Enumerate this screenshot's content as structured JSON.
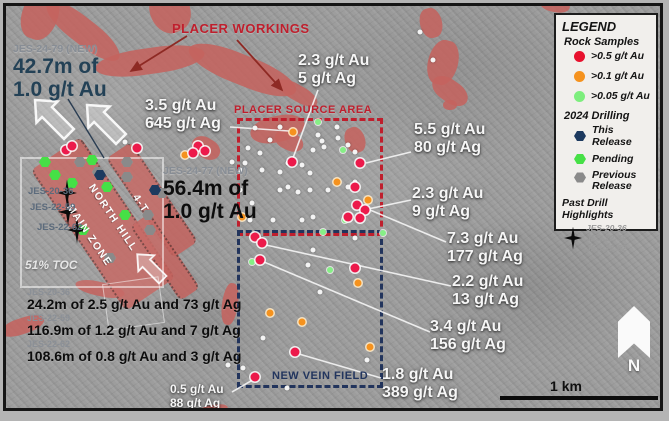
{
  "colors": {
    "salmon": "#c4635e",
    "crimson": "#bf1f2d",
    "steel_text": "#234156",
    "navy_text": "#22355e",
    "sample_red": "#ec1a4b",
    "sample_orange": "#f5921e",
    "sample_green": "#86ef86",
    "hex_navy": "#1d3a5f",
    "hex_green": "#46e046",
    "hex_gray": "#8a8a8a",
    "legend_bg": "#f1efec"
  },
  "annotations": {
    "placer_workings": "PLACER WORKINGS",
    "placer_source_area": "PLACER SOURCE AREA",
    "new_vein_field": "NEW VEIN FIELD",
    "north_hill": "NORTH HILL",
    "main_zone": "MAIN ZONE",
    "vein_4t": "4-T",
    "toc": "51% TOC",
    "scale_label": "1 km",
    "north_label": "N",
    "drill_new": [
      {
        "id": "JES-24-79 (NEW)",
        "line1": "42.7m of",
        "line2": "1.0 g/t Au"
      },
      {
        "id": "JES-24-77 (NEW)",
        "line1": "56.4m of",
        "line2": "1.0 g/t Au"
      }
    ],
    "samples": [
      {
        "line1": "2.3 g/t Au",
        "line2": "5 g/t Ag"
      },
      {
        "line1": "3.5 g/t Au",
        "line2": "645 g/t Ag"
      },
      {
        "line1": "5.5 g/t Au",
        "line2": "80 g/t Ag"
      },
      {
        "line1": "2.3 g/t Au",
        "line2": "9 g/t Ag"
      },
      {
        "line1": "7.3 g/t Au",
        "line2": "177 g/t Ag"
      },
      {
        "line1": "2.2 g/t Au",
        "line2": "13 g/t Ag"
      },
      {
        "line1": "3.4 g/t Au",
        "line2": "156 g/t Ag"
      },
      {
        "line1": "1.8 g/t Au",
        "line2": "389 g/t Ag"
      },
      {
        "line1": "0.5 g/t Au",
        "line2": "88 g/t Ag"
      }
    ],
    "star_holes": [
      "JES-20-36",
      "JES-22-59",
      "JES-22-62"
    ],
    "past_highlights": [
      {
        "id": "JES-20-36",
        "text": "24.2m of 2.5 g/t Au and 73 g/t Ag"
      },
      {
        "id": "JES-22-59",
        "text": "116.9m of 1.2 g/t Au and 7 g/t Ag"
      },
      {
        "id": "JES-22-62",
        "text": "108.6m of 0.8 g/t Au and 3 g/t Ag"
      }
    ]
  },
  "legend": {
    "title": "LEGEND",
    "rock_header": "Rock Samples",
    "rock": [
      {
        "color": "#e8112d",
        "label": ">0.5 g/t Au"
      },
      {
        "color": "#f5921e",
        "label": ">0.1 g/t Au"
      },
      {
        "color": "#7dee7d",
        "label": ">0.05 g/t Au"
      }
    ],
    "drilling_header": "2024 Drilling",
    "drilling": [
      {
        "color": "#1d3a5f",
        "label": "This Release"
      },
      {
        "color": "#46e046",
        "label": "Pending"
      },
      {
        "color": "#8a8a8a",
        "label": "Previous Release"
      }
    ],
    "past_header": "Past Drill Highlights",
    "past_ids": [
      "JES-20-36",
      "JES-22-59",
      "JES-22-62"
    ]
  },
  "markers": {
    "white": [
      [
        226,
        156
      ],
      [
        234,
        164
      ],
      [
        234,
        184
      ],
      [
        237,
        362
      ],
      [
        239,
        157
      ],
      [
        242,
        142
      ],
      [
        244,
        214
      ],
      [
        246,
        197
      ],
      [
        249,
        122
      ],
      [
        254,
        147
      ],
      [
        256,
        164
      ],
      [
        257,
        332
      ],
      [
        264,
        134
      ],
      [
        267,
        214
      ],
      [
        274,
        121
      ],
      [
        274,
        166
      ],
      [
        274,
        184
      ],
      [
        282,
        157
      ],
      [
        282,
        181
      ],
      [
        292,
        186
      ],
      [
        296,
        159
      ],
      [
        296,
        214
      ],
      [
        302,
        259
      ],
      [
        304,
        167
      ],
      [
        304,
        184
      ],
      [
        307,
        144
      ],
      [
        307,
        211
      ],
      [
        307,
        244
      ],
      [
        312,
        129
      ],
      [
        314,
        286
      ],
      [
        316,
        135
      ],
      [
        318,
        141
      ],
      [
        322,
        184
      ],
      [
        331,
        121
      ],
      [
        332,
        132
      ],
      [
        342,
        139
      ],
      [
        342,
        181
      ],
      [
        349,
        146
      ],
      [
        349,
        176
      ],
      [
        349,
        232
      ],
      [
        361,
        354
      ],
      [
        222,
        359
      ],
      [
        281,
        382
      ],
      [
        414,
        26
      ],
      [
        119,
        136
      ],
      [
        146,
        117
      ],
      [
        427,
        54
      ]
    ],
    "green": [
      [
        312,
        116
      ],
      [
        337,
        144
      ],
      [
        339,
        214
      ],
      [
        324,
        264
      ],
      [
        246,
        256
      ],
      [
        317,
        226
      ],
      [
        377,
        227
      ]
    ],
    "orange": [
      [
        287,
        126
      ],
      [
        331,
        176
      ],
      [
        362,
        194
      ],
      [
        236,
        211
      ],
      [
        352,
        277
      ],
      [
        264,
        307
      ],
      [
        296,
        316
      ],
      [
        364,
        341
      ],
      [
        179,
        149
      ]
    ],
    "red": [
      [
        286,
        156
      ],
      [
        354,
        157
      ],
      [
        349,
        181
      ],
      [
        351,
        199
      ],
      [
        359,
        204
      ],
      [
        342,
        211
      ],
      [
        354,
        212
      ],
      [
        249,
        231
      ],
      [
        256,
        237
      ],
      [
        254,
        254
      ],
      [
        349,
        262
      ],
      [
        289,
        346
      ],
      [
        249,
        371
      ],
      [
        192,
        140
      ],
      [
        199,
        145
      ],
      [
        187,
        147
      ],
      [
        60,
        144
      ],
      [
        66,
        140
      ],
      [
        131,
        142
      ]
    ],
    "hex_gray": [
      [
        74,
        156
      ],
      [
        92,
        166
      ],
      [
        121,
        156
      ],
      [
        121,
        171
      ],
      [
        142,
        209
      ],
      [
        144,
        224
      ],
      [
        104,
        252
      ],
      [
        156,
        187
      ]
    ],
    "hex_navy": [
      [
        94,
        169
      ],
      [
        149,
        184
      ]
    ],
    "hex_green": [
      [
        39,
        156
      ],
      [
        86,
        154
      ],
      [
        49,
        169
      ],
      [
        66,
        177
      ],
      [
        101,
        181
      ],
      [
        119,
        209
      ],
      [
        77,
        224
      ]
    ],
    "stars": [
      [
        61,
        187
      ],
      [
        62,
        206
      ],
      [
        71,
        224
      ]
    ]
  },
  "connectors": {
    "white_leaders": [
      [
        312,
        84,
        287,
        152
      ],
      [
        405,
        146,
        360,
        157
      ],
      [
        405,
        194,
        362,
        203
      ],
      [
        440,
        236,
        364,
        204
      ],
      [
        445,
        280,
        260,
        239
      ],
      [
        424,
        326,
        258,
        256
      ],
      [
        375,
        372,
        293,
        348
      ],
      [
        226,
        386,
        250,
        372
      ],
      [
        224,
        121,
        283,
        125
      ]
    ],
    "red_arrows": [
      [
        181,
        30,
        125,
        65
      ],
      [
        231,
        34,
        276,
        84
      ]
    ],
    "navy_leaders": [
      [
        62,
        93,
        98,
        152
      ]
    ]
  }
}
